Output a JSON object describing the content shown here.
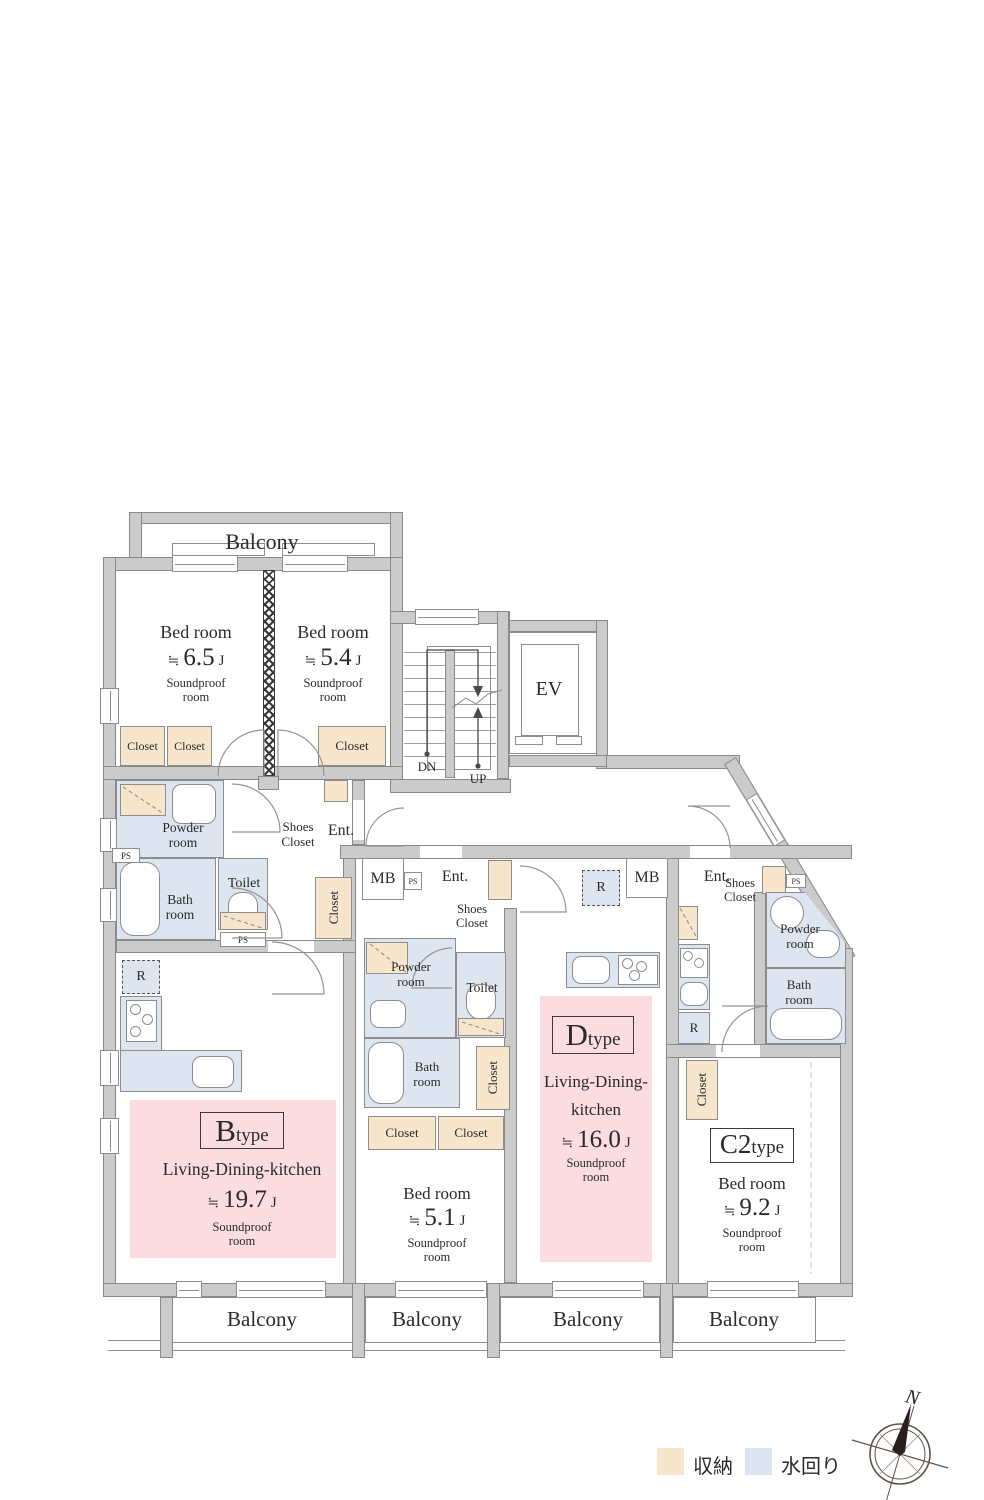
{
  "legend": {
    "storage_label": "収納",
    "water_label": "水回り",
    "storage_color": "#f7e6cb",
    "water_color": "#dce5f0"
  },
  "compass": {
    "north": "N"
  },
  "common": {
    "balcony": "Balcony",
    "closet": "Closet",
    "shoes_line1": "Shoes",
    "shoes_line2": "Closet",
    "powder_line1": "Powder",
    "powder_line2": "room",
    "bath_line1": "Bath",
    "bath_line2": "room",
    "toilet": "Toilet",
    "ent": "Ent.",
    "mb": "MB",
    "ps": "PS",
    "r": "R",
    "ev": "EV",
    "dn": "DN",
    "up": "UP",
    "approx": "≒",
    "unit": "J",
    "soundproof_line1": "Soundproof",
    "soundproof_line2": "room"
  },
  "rooms": {
    "bedroom_a1": {
      "name": "Bed room",
      "value": "6.5"
    },
    "bedroom_a2": {
      "name": "Bed room",
      "value": "5.4"
    },
    "bedroom_d": {
      "name": "Bed room",
      "value": "5.1"
    },
    "bedroom_c2": {
      "name": "Bed room",
      "value": "9.2"
    },
    "unit_b": {
      "type_letter": "B",
      "type_suffix": "type",
      "room": "Living-Dining-kitchen",
      "value": "19.7"
    },
    "unit_d": {
      "type_letter": "D",
      "type_suffix": "type",
      "room_line1": "Living-Dining-",
      "room_line2": "kitchen",
      "value": "16.0"
    },
    "unit_c2": {
      "type_letter": "C2",
      "type_suffix": "type"
    }
  }
}
